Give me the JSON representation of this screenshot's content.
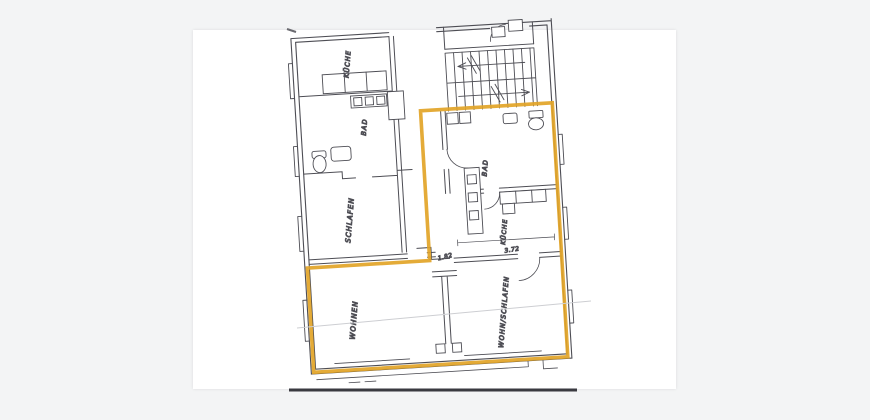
{
  "viewer": {
    "background_color": "#f3f4f5",
    "page_color": "#ffffff"
  },
  "plan": {
    "highlight_color": "#e2a427",
    "ink_color": "#4d4d54",
    "rooms": [
      {
        "label": "KÜCHE"
      },
      {
        "label": "BAD"
      },
      {
        "label": "SCHLAFEN"
      },
      {
        "label": "WOHNEN"
      },
      {
        "label": "BAD"
      },
      {
        "label": "KÜCHE"
      },
      {
        "label": "WOHN/SCHLAFEN"
      }
    ],
    "dimensions": [
      {
        "label": "1.82"
      },
      {
        "label": "3.72"
      }
    ]
  }
}
